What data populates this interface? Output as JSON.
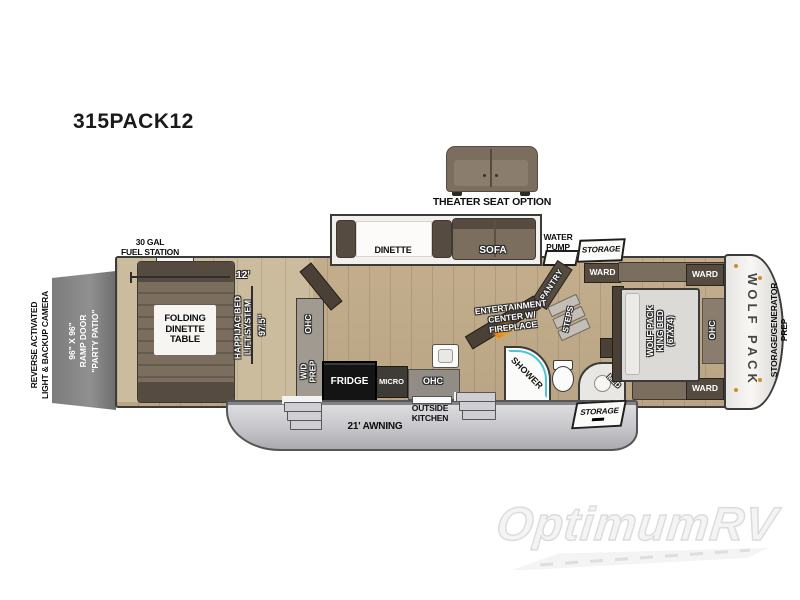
{
  "title": "315PACK12",
  "colors": {
    "wall": "#3b3b3b",
    "floor": "#c3ad8c",
    "floor_garage": "#ccbc9e",
    "slide_floor": "#f2f0ec",
    "furniture": "#7b6e5f",
    "furniture_dark": "#564b40",
    "cabinet_dark": "#4a4036",
    "counter": "#a09a90",
    "appliance_black": "#141414",
    "skirt_edge": "#55555a",
    "cap_white": "#f4f3ef",
    "accent_orange": "#cf8c2e",
    "fireplace_orange": "#e8941c",
    "shower_teal": "#4cc5d6"
  },
  "labels": {
    "camera": "REVERSE ACTIVATED\nLIGHT & BACKUP CAMERA",
    "ramp_door": "96\" X 96\"\nRAMP DOOR\n\"PARTY PATIO\"",
    "fuel_station": "30 GAL\nFUEL STATION",
    "garage_length": "12'",
    "garage_width": "97.5\"",
    "happijac": "HAPPIJAC BED\nLIFT SYSTEM",
    "folding_dinette": "FOLDING\nDINETTE\nTABLE",
    "garage_ohc": "OHC",
    "wd_prep": "W/D\nPREP",
    "fridge": "FRIDGE",
    "micro": "MICRO",
    "kitchen_ohc": "OHC",
    "dinette": "DINETTE",
    "sofa": "SOFA",
    "theater_seat_option": "THEATER SEAT OPTION",
    "water_pump": "WATER\nPUMP",
    "storage_top": "STORAGE",
    "ward_entry": "WARD",
    "pantry": "PANTRY",
    "steps": "STEPS",
    "entertainment": "ENTERTAINMENT\nCENTER W/\nFIREPLACE",
    "shower": "SHOWER",
    "med": "MED",
    "bed": "WOLF PACK\nKING BED\n(67X74)",
    "ward_top": "WARD",
    "ward_bottom": "WARD",
    "bedroom_ohc": "OHC",
    "wolf_pack": "WOLF PACK",
    "front_prep": "STORAGE/GENERATOR\nPREP",
    "awning": "21' AWNING",
    "outside_kitchen": "OUTSIDE\nKITCHEN",
    "storage_bottom": "STORAGE",
    "watermark": "OptimumRV"
  }
}
